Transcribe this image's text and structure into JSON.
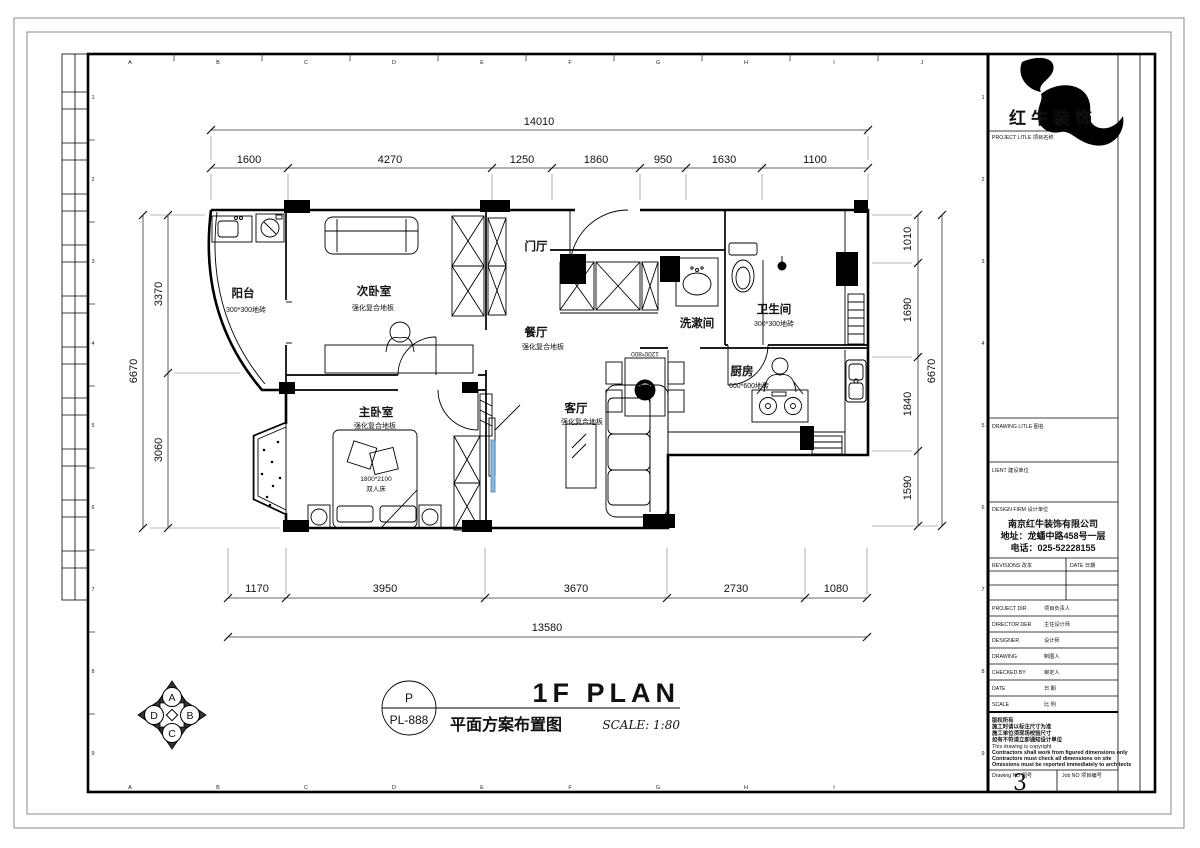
{
  "sheet": {
    "grid_letters": [
      "A",
      "B",
      "C",
      "D",
      "E",
      "F",
      "G",
      "H",
      "I",
      "J"
    ],
    "grid_numbers": [
      "1",
      "2",
      "3",
      "4",
      "5",
      "6",
      "7",
      "8",
      "9"
    ]
  },
  "title_block": {
    "brand": "红牛装饰",
    "project_title_label": "PROJECT LITLE  项目名称",
    "drawing_title_label": "DRAWING LITLE  图名",
    "client_label": "LIENT  建设单位",
    "design_firm_label": "DESIGN FIRM  设计单位",
    "firm_name": "南京红牛装饰有限公司",
    "firm_address": "地址：龙蟠中路458号一层",
    "firm_phone": "电话：025-52228155",
    "revisions_label": "REVISIONS  改本",
    "date_col_label": "DATE  日期",
    "rows": [
      {
        "label": "PROJECT DIR",
        "zh": "项目负责人"
      },
      {
        "label": "DIRECTOR DER",
        "zh": "主任设计师"
      },
      {
        "label": "DESIGNER",
        "zh": "设计师"
      },
      {
        "label": "DRAWING",
        "zh": "制图人"
      },
      {
        "label": "CHECKED BY",
        "zh": "审定人"
      },
      {
        "label": "DATE",
        "zh": "日  期"
      },
      {
        "label": "SCALE",
        "zh": "比  例"
      }
    ],
    "notes": [
      "版权所有",
      "施工时请以标注尺寸为准",
      "施工单位须现场校验尺寸",
      "如有不符请立即通知设计单位",
      "This drawing is copyright",
      "Contractors shall work from figured dimensions only",
      "Contractors must check all dimensions on site",
      "Omissions must be reported immediately to architects"
    ],
    "drawing_no_label": "Drawing NO  图号",
    "drawing_no": "3",
    "job_no_label": "Job NO  项目编号"
  },
  "plan": {
    "rooms": [
      {
        "name": "阳台",
        "sub": "300*300地砖"
      },
      {
        "name": "次卧室",
        "sub": "强化复合地板"
      },
      {
        "name": "门厅",
        "sub": ""
      },
      {
        "name": "餐厅",
        "sub": "强化复合地板"
      },
      {
        "name": "洗漱间",
        "sub": ""
      },
      {
        "name": "卫生间",
        "sub": "300*300地砖"
      },
      {
        "name": "厨房",
        "sub": "600*600地砖"
      },
      {
        "name": "客厅",
        "sub": "强化复合地板"
      },
      {
        "name": "主卧室",
        "sub": "强化复合地板"
      }
    ],
    "furniture_labels": {
      "dining_table": "1200*800",
      "bed_size": "1800*2100",
      "bed_name": "双人床"
    },
    "dims": {
      "top_total": "14010",
      "top": [
        "1600",
        "4270",
        "1250",
        "1860",
        "950",
        "1630",
        "1100"
      ],
      "bottom": [
        "1170",
        "3950",
        "3670",
        "2730",
        "1080"
      ],
      "bottom_total": "13580",
      "left_total": "6670",
      "left": [
        "3370",
        "3060"
      ],
      "right": [
        "1010",
        "1690",
        "1840",
        "1590"
      ],
      "right_total": "6670"
    }
  },
  "footer": {
    "title_en": "1F PLAN",
    "title_zh": "平面方案布置图",
    "scale": "SCALE:  1:80",
    "tag_top": "P",
    "tag_bottom": "PL-888",
    "compass": {
      "n": "A",
      "e": "B",
      "s": "C",
      "w": "D"
    }
  }
}
